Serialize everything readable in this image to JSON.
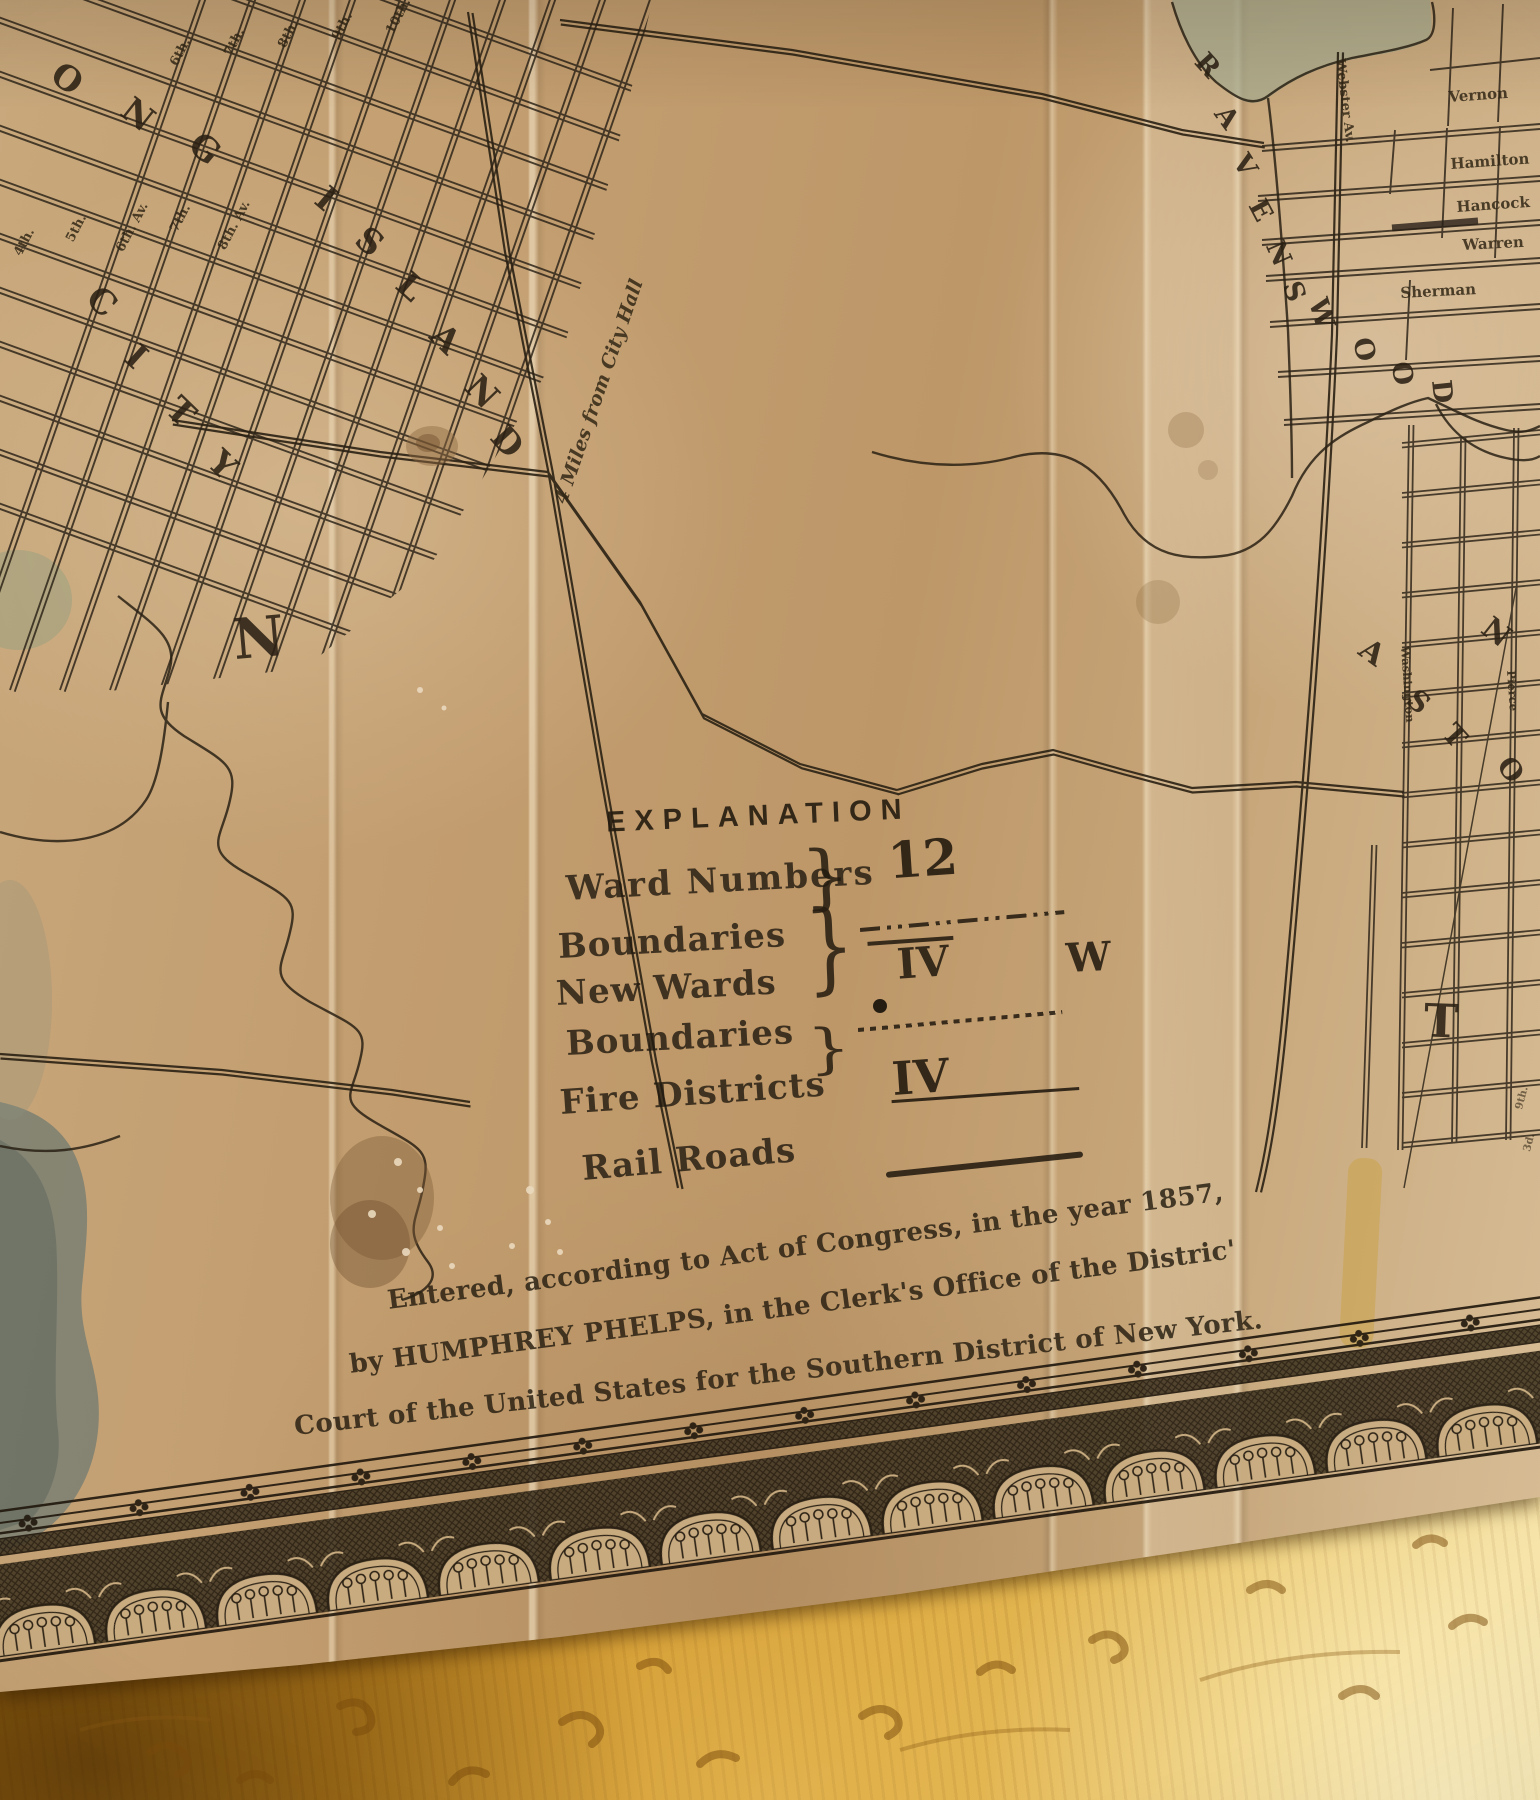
{
  "artifact": {
    "compass_north": "N",
    "distance_label": "4 Miles from City Hall",
    "explanation": {
      "title": "EXPLANATION",
      "ward_numbers_label": "Ward Numbers",
      "ward_numbers_symbol": "12",
      "boundaries1_label": "Boundaries",
      "new_wards_label": "New Wards",
      "new_wards_symbol": "IV",
      "new_wards_extra": "W",
      "boundaries2_label": "Boundaries",
      "fire_districts_label": "Fire Districts",
      "fire_districts_symbol": "IV",
      "rail_roads_label": "Rail Roads",
      "brace": "}"
    },
    "copyright_line1": "Entered, according to Act of Congress, in the year 1857,",
    "copyright_line2": "by HUMPHREY PHELPS, in the Clerk's Office of the Distric'",
    "copyright_line3": "Court of the United States for the Southern District of New York.",
    "letters": {
      "long": [
        "O",
        "N",
        "G"
      ],
      "island": [
        "I",
        "S",
        "L",
        "A",
        "N",
        "D"
      ],
      "city": [
        "C",
        "I",
        "T",
        "Y"
      ],
      "ravenswood": [
        "R",
        "A",
        "V",
        "E",
        "N",
        "S",
        "W",
        "O",
        "O",
        "D"
      ],
      "astoria": [
        "A",
        "S",
        "T",
        "O"
      ],
      "newtown_n": "N",
      "big_t": "T"
    },
    "streets": {
      "ravenswood_streets": [
        "Vernon",
        "Hamilton",
        "Hancock",
        "Warren",
        "Sherman"
      ],
      "webster": "Webster Av.",
      "washington": "Washington",
      "pierce": "Pierce",
      "numbered_top": [
        "6th.",
        "7th.",
        "8th.",
        "9th.",
        "10th."
      ],
      "numbered_mid": [
        "4th.",
        "5th.",
        "6th. Av.",
        "7th.",
        "8th. Av."
      ],
      "right_edge": [
        "9th.",
        "3d."
      ]
    }
  }
}
